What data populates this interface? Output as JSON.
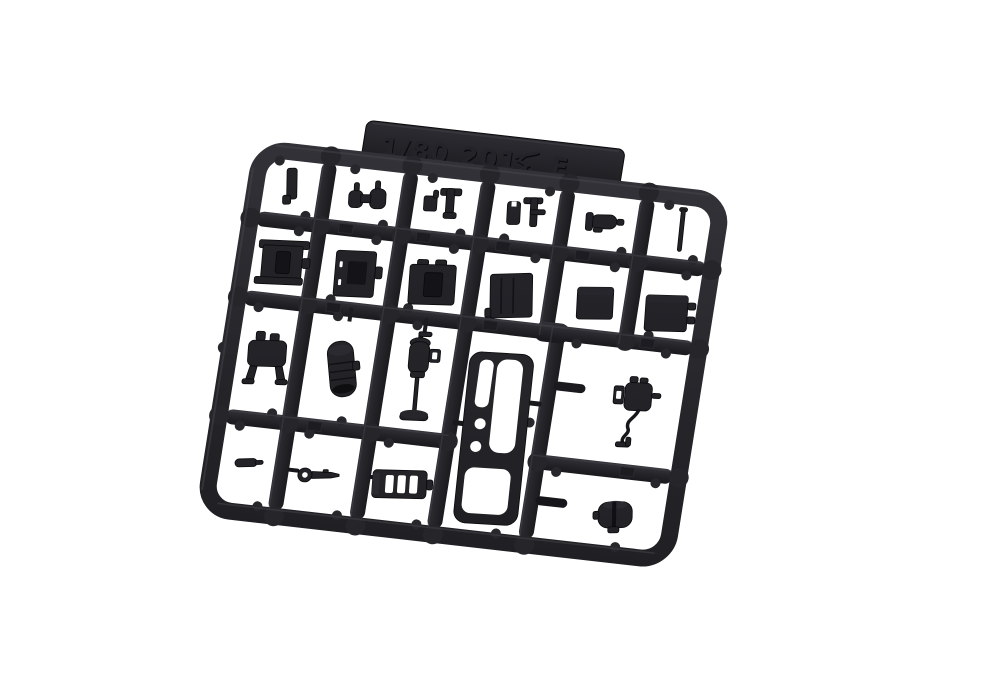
{
  "meta": {
    "type": "product-photo",
    "subject": "Black injection-molded plastic model kit parts runner (sprue E) for a 1/80 scale 201-series train kit, photographed on a plain white background, tilted slightly clockwise",
    "background_color": "#ffffff"
  },
  "colors": {
    "plastic": "#232328",
    "plastic_dark": "#121216",
    "plastic_light": "#37373d",
    "emboss_text": "#141417",
    "cutout": "#ffffff"
  },
  "tab": {
    "full_text": "1/80 201系 E",
    "text_left": "1/80 201",
    "text_kanji": "系",
    "text_right": "E"
  },
  "sprue": {
    "rotation_deg": 6.5,
    "grid": {
      "columns": 6,
      "rows": 4
    },
    "parts": [
      {
        "cell": "r1c1",
        "name": "small-pillar"
      },
      {
        "cell": "r1c2",
        "name": "coupler-knuckle-pair"
      },
      {
        "cell": "r1c3",
        "name": "lever-pair"
      },
      {
        "cell": "r1c4",
        "name": "lever-pair-2"
      },
      {
        "cell": "r1c5",
        "name": "small-cylinder"
      },
      {
        "cell": "r1c6",
        "name": "thin-rod"
      },
      {
        "cell": "r2c1",
        "name": "equipment-box-flanged"
      },
      {
        "cell": "r2c2",
        "name": "equipment-box-door"
      },
      {
        "cell": "r2c3",
        "name": "equipment-box"
      },
      {
        "cell": "r2c4",
        "name": "equipment-box-grooved"
      },
      {
        "cell": "r2c5",
        "name": "equipment-box-small"
      },
      {
        "cell": "r2c6",
        "name": "equipment-box-tabs"
      },
      {
        "cell": "r3c1",
        "name": "tank-with-legs"
      },
      {
        "cell": "r3c2",
        "name": "main-air-reservoir"
      },
      {
        "cell": "r3c3",
        "name": "compressor-with-drain-pipe"
      },
      {
        "cell": "r3c4-r4c4",
        "name": "cab-front-panel"
      },
      {
        "cell": "r3c5",
        "name": "compressor-with-hose"
      },
      {
        "cell": "r4c1",
        "name": "small-bracket"
      },
      {
        "cell": "r4c2",
        "name": "key-shaped-lever"
      },
      {
        "cell": "r4c3",
        "name": "ribbed-box"
      },
      {
        "cell": "r4c5",
        "name": "small-tank"
      }
    ]
  }
}
